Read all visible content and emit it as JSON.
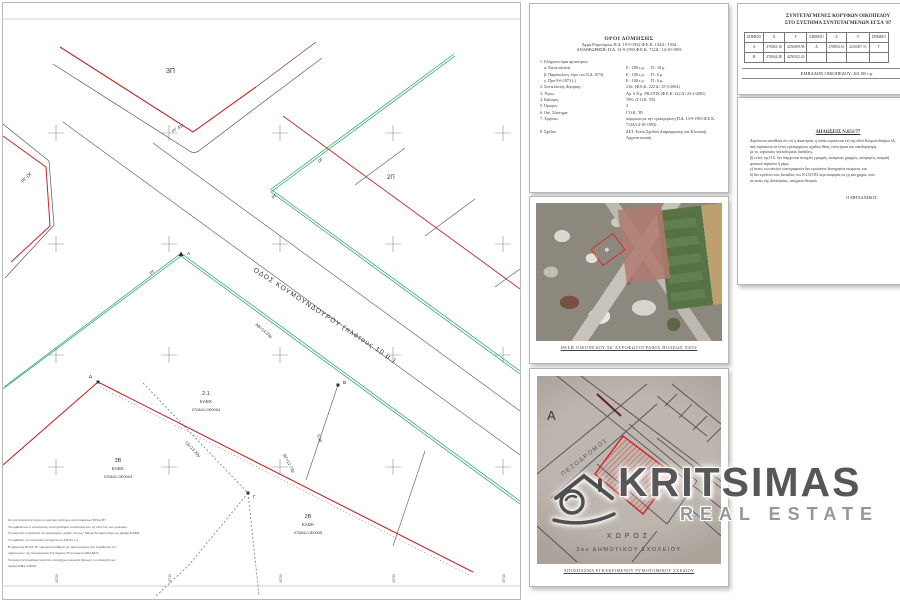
{
  "drawing": {
    "street_label": "ΟΔΟΣ ΚΟΥΜΟΥΝΔΟΥΡΟΥ (πλάτους 10 μ.)",
    "blocks": {
      "b3p": "3Π",
      "b2p": "2Π"
    },
    "parcels": {
      "p1": {
        "num": "2.1",
        "kaek_label": "ΚΑΕΚ",
        "kaek": "070841-0Ε0004"
      },
      "p2": {
        "num": "3Β",
        "kaek_label": "ΚΑΕΚ",
        "kaek": "070841-0Ε0003"
      },
      "p3": {
        "num": "2Β",
        "kaek_label": "ΚΑΕΚ",
        "kaek": "070841-0Ε0005"
      }
    },
    "line_labels": {
      "rg_og": "ΡΓ-ΟΓ",
      "rg411": "ΡΓ 411",
      "og": "ΟΓ",
      "rg": "ΡΓ",
      "rg2": "ΡΓ"
    },
    "points": {
      "a": "Α",
      "b": "Β",
      "g": "Γ",
      "d": "Δ"
    },
    "measures": {
      "ab": "ΑΒ=14.03μ",
      "bg": "ΒΓ=12.73μ",
      "gd": "ΓΔ=13.30μ",
      "seg": "5.00"
    },
    "notes": [
      "Οι συντεταγμένες είναι στο κρατικό σύστημα συντεταγμένων ΕΓΣΑ '87.",
      "Τα εμβαδά και οι αποστάσεις υπολογίσθηκαν αναλυτικά από τις συντ/νες των κορυφών.",
      "Το οικόπεδο ευρίσκεται σε εγκεκριμένο σχέδιο πόλεως· Εθνικό Κτηματολόγιο με αριθμό ΚΑΕΚ.",
      "Το εμβαδόν του οικοπέδου ανέρχεται σε 259.25 τ.μ.",
      "Η εξάρτηση ΕΓΣΑ '87 πραγματοποιήθηκε με παρατηρήσεις που ελήφθησαν την",
      "ημέρα μέσω του δορυφορικού Συστήματος Εντοπισμού URANUS.",
      "Τα όρια απετυπώθηκαν κατόπιν υποδείξεως και κατά δήλωση του ιδιοκτήτη με",
      "αριθμό ΚΗΔ 3/2009."
    ],
    "ticks": [
      "45700",
      "45710",
      "45720",
      "45730",
      "45740"
    ]
  },
  "doc_terms": {
    "title": "ΟΡΟΙ ΔΟΜΗΣΗΣ",
    "sub1": "Δγμα Ρυμοτομίας Π.Δ. 19-9-1932  Φ.Ε.Κ. 134Α / 1934",
    "sub2": "ΑΝΑΘΕΩΡΗΣΗ:  Π.Δ. 13-9-1993  Φ.Ε.Κ. 712Δ / 14-10-1993",
    "rows": [
      {
        "label": "1. Ελάχιστα όρια αρτιότητας:",
        "value": ""
      },
      {
        "label": "    α. Κατά κανόνα,",
        "value": "Ε : 200 τ.μ.      Π : 10 μ."
      },
      {
        "label": "    β. Παρέκκλιση  (προ του Ν.Δ. 8/73)",
        "value": "Ε : 100 τ.μ.      Π : 6 μ."
      },
      {
        "label": "    γ. Προ 9-6-1973 (;)",
        "value": "Ε : 100 τ.μ.      Π : 6 μ."
      },
      {
        "label": "2. Συντελεστής Δόμησης :",
        "value": "2.0ε  (Φ.Ε.Κ. 222 Δ / 25-3-2004)"
      },
      {
        "label": "3. Ύψος:",
        "value": "Αρ. 6 Ν.μ. PILOTIS (Φ.Ε.Κ. 222 Δ / 23-2-2001)"
      },
      {
        "label": "4. Κάλυψη:",
        "value": "70%  (Γ.Ο.Κ. '85)"
      },
      {
        "label": "5. Όροφοι:",
        "value": "3"
      },
      {
        "label": "6. Οικ. Σύστημα:",
        "value": "Γ.Ο.Κ. '85"
      },
      {
        "label": "7. Χρήσεις:",
        "value": "σύμφωνα με την εγκεκριμένη (Π.Δ. 13-9-1993 Φ.Ε.Κ. 712Δ/14-10-1993)"
      },
      {
        "label": "8. Σχόλια:",
        "value": "ΔΣΤ: Εντός Σχεδίου Διαμόρφωσης και Κλασικής Αρχιτεκτονικής"
      }
    ]
  },
  "doc_coords": {
    "title1": "ΣΥΝΤΕΤΑΓΜΕΝΕΣ ΚΟΡΥΦΩΝ ΟΙΚΟΠΕΔΟΥ",
    "title2": "ΣΤΟ ΣΥΣΤΗΜΑ ΣΥΝΤΕΤΑΓΜΕΝΩΝ ΕΓΣΑ '87",
    "table": {
      "headers": [
        "ΣΗΜΕΙΟ",
        "Χ",
        "Υ",
        "ΣΗΜΕΙΟ",
        "Χ",
        "Υ",
        "ΣΗΜΕΙΟ"
      ],
      "rows": [
        [
          "Α",
          "478043.10",
          "4250309.96",
          "Δ",
          "478094.16",
          "4250307.51",
          "Γ"
        ],
        [
          "Β",
          "478044.48",
          "4250342.43",
          "",
          "",
          "",
          ""
        ]
      ]
    },
    "area_label": "ΕΜΒΑΔΟΝ ΟΙΚΟΠΕΔΟΥ:",
    "area_value": "261.88 τ.μ."
  },
  "doc_decl": {
    "title": "ΔΗΛΩΣΕΙΣ Ν.651/77",
    "lines": [
      "Δηλώνεται υπεύθυνα ότι: α) η ιδιοκτησία, η οποία ευρίσκεται επί της οδού Κουμουνδούρου (Δ.",
      "αα) ευρίσκεται σε εντός εγκεκριμένου σχεδίου θέση, είναι άρτια και οικοδομήσιμη,",
      "με τις ισχύουσες πολεοδομικές διατάξεις,",
      "β) εντός της Ο.Σ. δεν διέρχονται ανοιχτές γραμμές, ασώματες γραμμές, αποφορείς, ασφαλή",
      "φυσικού αιγιαλού ή ρέμα,",
      "γ) στους των ακείων τοπογραφικών δεν εμπίπτουν διατηρητέα κτίσματα, και",
      "δ) δεν εμπίπτει στις διατάξεις του Ν.1337/83 περί εισφοράς σε γη και χρήμα, ούτε",
      "σε αυτές της ιδιοκτησίας, υπόχρεου θεσμού."
    ],
    "signature": "Ο ΜΗΧΑΝΙΚΟΣ"
  },
  "aerial": {
    "caption": "ΘΕΣΗ ΟΙΚΟΠΕΔΟΥ ΣΕ ΑΕΡΟΦΩΤΟΓΡΑΦΙΑ ΠΟΛΕΩΣ ΧΙΟΥ"
  },
  "cadastral": {
    "label_a": "Α",
    "pezodromos": "ΠΕΖΟΔΡΟΜΟΣ",
    "xoros": "ΧΩΡΟΣ",
    "school": "2ου  ΔΗΜΟΤΙΚΟΥ  ΣΧΟΛΕΙΟΥ",
    "caption": "ΑΠΟΣΠΑΣΜΑ ΕΓΚΕΚΡΙΜΕΝΟΥ ΡΥΜΟΤΟΜΙΚΟΥ ΣΧΕΔΙΟΥ"
  },
  "watermark": {
    "brand": "KRITSIMAS",
    "tagline": "REAL ESTATE"
  }
}
